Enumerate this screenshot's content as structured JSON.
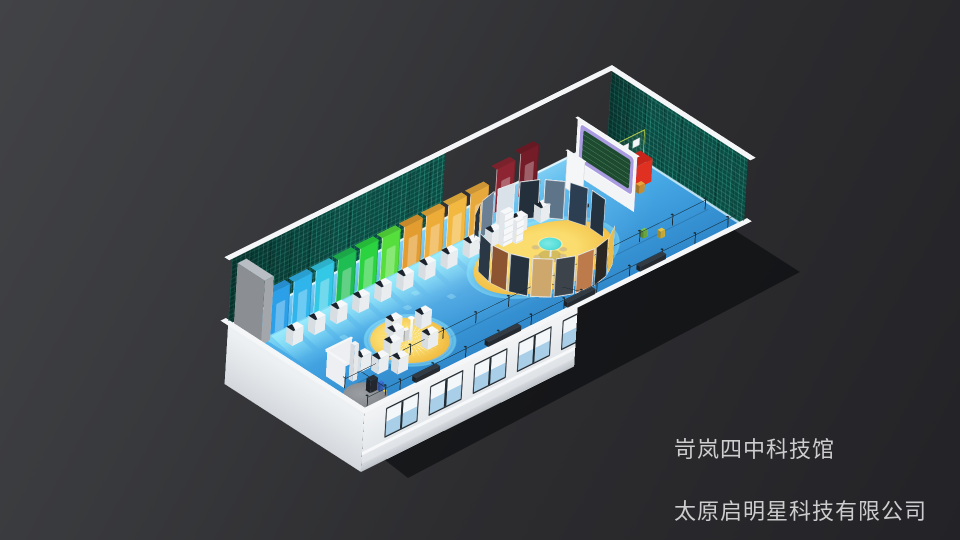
{
  "watermark": {
    "line1": "岢岚四中科技馆",
    "line2": "太原启明星科技有限公司"
  },
  "scene": {
    "origin": {
      "x": 228,
      "y": 325
    },
    "matrix": [
      0.345,
      -0.171,
      -0.3,
      0,
      0.31,
      0.2,
      0.8,
      0,
      0.03,
      -0.5,
      0.6,
      0,
      0,
      0,
      0,
      1
    ],
    "room": {
      "length": 1100,
      "depth": 440,
      "wallHeight": 135,
      "parapetHeight": 8,
      "facadeHeight": 118
    },
    "colors": {
      "floorA": "#7CCDF4",
      "floorB": "#47A9E6",
      "floorC": "#3A97D8",
      "floorD": "#2E86C8",
      "cap": "#F4F6F8",
      "parapet": "#E2E6E9",
      "frame": "#232B33",
      "glassTop": "#F3F7F9",
      "glassBot": "#A9CFE8",
      "sill": "#F6F8FA",
      "yellow": "#F2BE45",
      "yellowHi": "#FADD6E",
      "tableTop": "#F5F7F9",
      "tableFront": "#E9EDF0",
      "tableSide": "#D8DDE2",
      "screen": "#1C232C",
      "cable": "#14262E",
      "post": "#1D2B33",
      "purpleFrame": "#A99BE0",
      "board": "#1E4A30",
      "boardLine": "rgba(150,230,180,0.45)",
      "red": "#E03022",
      "redSide": "#A8140C",
      "redTop": "#C9241A",
      "frameYellow": "#CEE24A",
      "cyanTable": "#58DEDA",
      "stool": "#D8C08A",
      "arcEdge": "#E9ECEF",
      "grayPanel": "#B9BEC4",
      "blueFig": "#3D6FD8",
      "glow": "rgba(165,246,255,0.55)"
    },
    "booths": {
      "width": 54,
      "height": 86,
      "y": 88,
      "items": [
        {
          "x": 40,
          "color": "#2B9FE8"
        },
        {
          "x": 104,
          "color": "#2FB4EC"
        },
        {
          "x": 168,
          "color": "#33C9E6"
        },
        {
          "x": 232,
          "color": "#1FBE52"
        },
        {
          "x": 296,
          "color": "#2BD341"
        },
        {
          "x": 360,
          "color": "#55DE3C"
        },
        {
          "x": 424,
          "color": "#E29C2F"
        },
        {
          "x": 488,
          "color": "#EDAB38"
        },
        {
          "x": 552,
          "color": "#F2B840"
        },
        {
          "x": 616,
          "color": "#E8A93C"
        },
        {
          "x": 690,
          "color": "#8C2531",
          "lift": 24
        },
        {
          "x": 758,
          "color": "#741C28",
          "lift": 32
        }
      ]
    },
    "windows": {
      "y": 12,
      "width": 96,
      "height": 60,
      "xs": [
        64,
        192,
        320,
        448,
        576,
        704,
        832,
        960
      ]
    },
    "yellowCircle": {
      "x": 258,
      "y": 300,
      "r": 86
    },
    "grayCircle": {
      "x": 46,
      "y": 392,
      "r": 48
    },
    "ovalPlatform": {
      "x": 687,
      "y": 252,
      "rx": 175,
      "ry": 112
    },
    "roundTable": {
      "x": 700,
      "y": 258,
      "r": 24
    },
    "stools": [
      [
        664,
        258
      ],
      [
        680,
        288
      ],
      [
        708,
        290
      ],
      [
        726,
        272
      ],
      [
        716,
        234
      ],
      [
        686,
        228
      ]
    ],
    "shelves": [
      {
        "x": 648,
        "y": 150,
        "w": 26,
        "d": 16,
        "h": 66
      },
      {
        "x": 676,
        "y": 162,
        "w": 20,
        "d": 14,
        "h": 46
      }
    ],
    "lowerArc": {
      "r": 150,
      "panelW": 46,
      "panelH": 78,
      "panels": [
        {
          "a": 58,
          "color": "#E9BC4F"
        },
        {
          "a": 77,
          "color": "#2B2722"
        },
        {
          "a": 96,
          "color": "#BD7B4C"
        },
        {
          "a": 115,
          "color": "#3C434B"
        },
        {
          "a": 134,
          "color": "#CDA76C"
        },
        {
          "a": 153,
          "color": "#26333F"
        },
        {
          "a": 172,
          "color": "#8C5430"
        },
        {
          "a": 191,
          "color": "#2A3744"
        }
      ]
    },
    "upperArc": {
      "r": 150,
      "panelW": 46,
      "panelH": 78,
      "panels": [
        {
          "a": 236,
          "color": "#27333F"
        },
        {
          "a": 257,
          "color": "#6B7F94"
        },
        {
          "a": 278,
          "color": "#D9E2E8"
        },
        {
          "a": 299,
          "color": "#23303C"
        },
        {
          "a": 320,
          "color": "#5E7488"
        },
        {
          "a": 341,
          "color": "#2B3E52"
        },
        {
          "a": 2,
          "color": "#243240"
        }
      ]
    },
    "extraTables": [
      [
        214,
        272
      ],
      [
        262,
        330
      ],
      [
        304,
        262
      ],
      [
        238,
        240
      ],
      [
        120,
        328
      ],
      [
        152,
        356
      ],
      [
        96,
        298
      ],
      [
        180,
        300
      ]
    ],
    "leftWalls": [
      {
        "x": 30,
        "y": 282,
        "rz": 0,
        "len": 72,
        "h": 52
      },
      {
        "x": 30,
        "y": 282,
        "rz": 90,
        "len": 60,
        "h": 52
      }
    ],
    "column": {
      "x": 60,
      "y": 322,
      "w": 13,
      "d": 13,
      "h": 72
    },
    "grayCabinet": {
      "x": 4,
      "y": 14,
      "w": 26,
      "d": 88,
      "h": 128
    },
    "projScreen": {
      "x": 900,
      "y": 85,
      "len": 58,
      "h": 76
    },
    "board": {
      "x": 952,
      "y": 58,
      "len": 192,
      "h": 112
    },
    "machine": {
      "x": 1002,
      "y": 148,
      "w": 56,
      "d": 40,
      "h": 46
    },
    "machineFrame": {
      "x": 1002,
      "y": 132,
      "len": 82,
      "h": 74
    },
    "smallItems": [
      {
        "x": 1006,
        "y": 194,
        "w": 16,
        "d": 12,
        "h": 16,
        "color": "#E8A43C"
      },
      {
        "x": 900,
        "y": 328,
        "w": 12,
        "d": 10,
        "h": 14,
        "color": "#7BC24A"
      },
      {
        "x": 928,
        "y": 352,
        "w": 12,
        "d": 10,
        "h": 14,
        "color": "#E8C43C"
      },
      {
        "x": 875,
        "y": 162,
        "w": 16,
        "d": 10,
        "h": 6,
        "color": "#20262C"
      },
      {
        "x": 246,
        "y": 286,
        "w": 12,
        "d": 10,
        "h": 22,
        "color": "#F5F7F9"
      },
      {
        "x": 58,
        "y": 380,
        "w": 20,
        "d": 14,
        "h": 26,
        "color": "#2A2F36"
      },
      {
        "x": 78,
        "y": 396,
        "w": 9,
        "d": 8,
        "h": 18,
        "color": "#3D6FD8"
      }
    ],
    "benches": [
      {
        "x": 360,
        "y": 426,
        "w": 95
      },
      {
        "x": 590,
        "y": 426,
        "w": 80
      },
      {
        "x": 800,
        "y": 426,
        "w": 75
      },
      {
        "x": 150,
        "y": 426,
        "w": 70
      }
    ],
    "ropes": {
      "height": 18,
      "postSpacing": 95,
      "lines": [
        {
          "x": 30,
          "y": 340,
          "len": 1050,
          "axis": "x"
        },
        {
          "x": 20,
          "y": 424,
          "len": 1070,
          "axis": "x"
        },
        {
          "x": 76,
          "y": 340,
          "len": 84,
          "axis": "y"
        },
        {
          "x": 600,
          "y": 342,
          "len": 92,
          "axis": "d",
          "ang": 64
        }
      ]
    },
    "glowMarks": [
      [
        150,
        190
      ],
      [
        240,
        215
      ],
      [
        330,
        195
      ],
      [
        430,
        225
      ],
      [
        530,
        205
      ],
      [
        640,
        230
      ],
      [
        100,
        260
      ],
      [
        710,
        205
      ],
      [
        380,
        165
      ],
      [
        560,
        170
      ]
    ]
  }
}
